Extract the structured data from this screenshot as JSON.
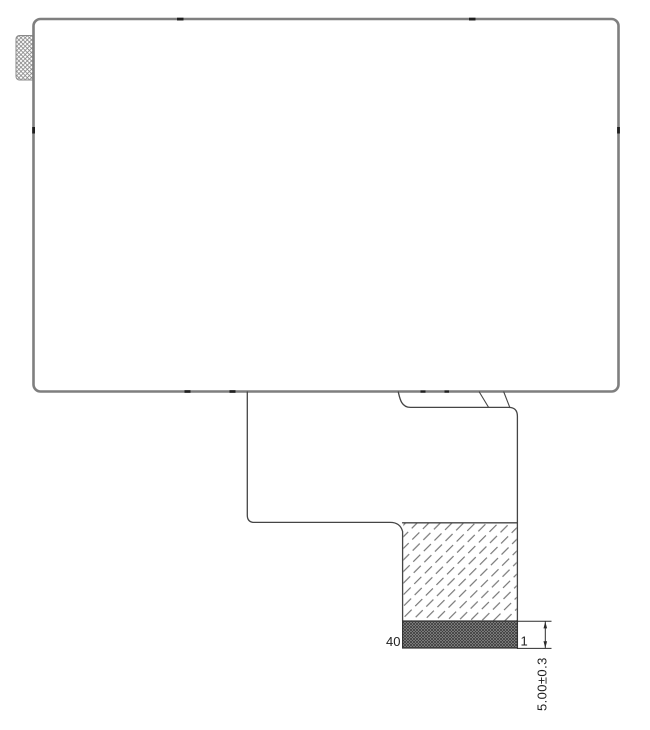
{
  "page": {
    "background": "#ffffff",
    "description": "Mechanical outline drawing of an LCD display module with FPC tail, stiffener and 40-pin contact bar"
  },
  "drawing": {
    "labels": {
      "pin_left": "40",
      "pin_right": "1",
      "thickness_dimension": "5.00±0.3"
    },
    "colors": {
      "panel_outline": "#7f7f7f",
      "fpc_outline": "#454545",
      "hatch_line": "#6e6e6e",
      "pad_hatch_line": "#858585",
      "contact_bar_fill": "#a0a0a0",
      "contact_bar_crosshatch": "#3c3c3c",
      "dimension_line": "#2b2b2b",
      "text": "#1f1f1f",
      "tick_mark": "#1f1f1f"
    }
  }
}
